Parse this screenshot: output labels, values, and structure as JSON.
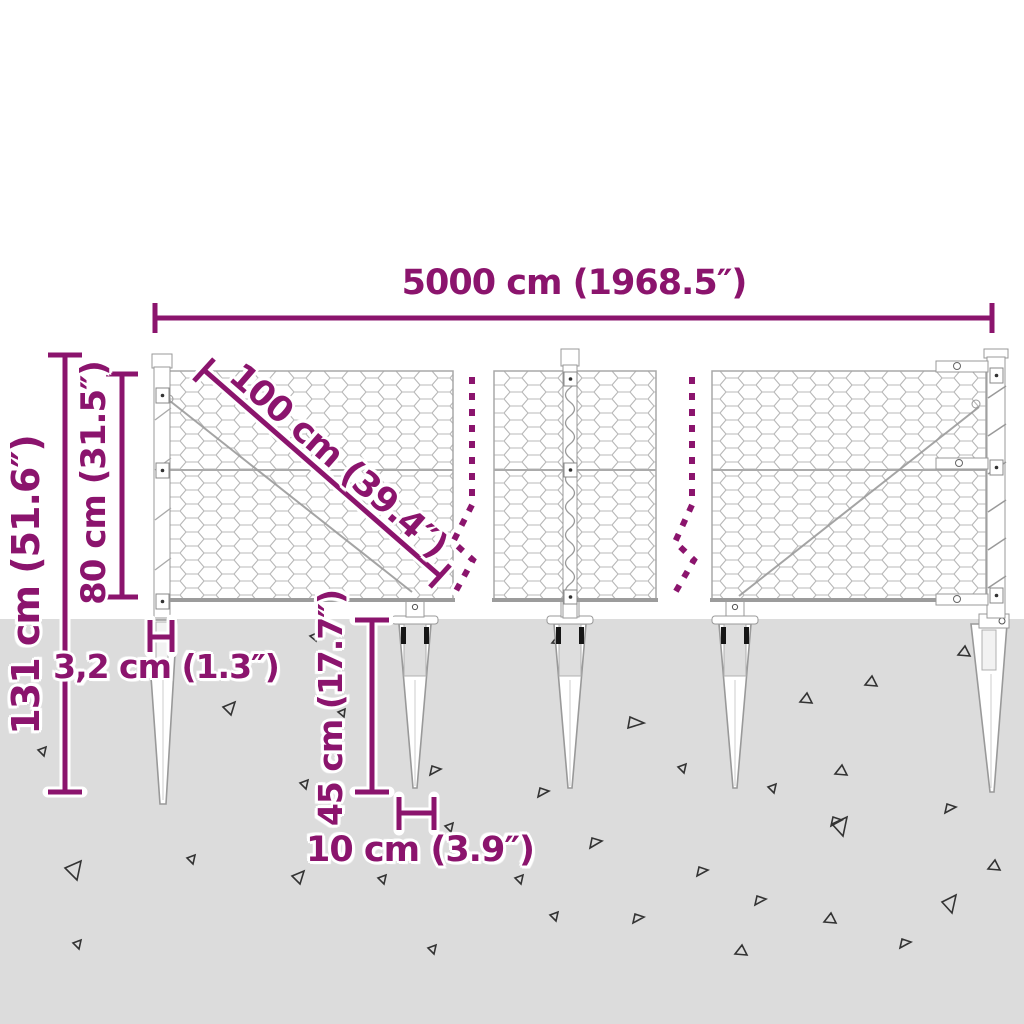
{
  "diagram": {
    "labels": {
      "total_width": "5000 cm (1968.5″)",
      "overall_height": "131 cm (51.6″)",
      "mesh_height": "80 cm (31.5″)",
      "mesh_diagonal": "100 cm (39.4″)",
      "post_width": "3,2 cm (1.3″)",
      "anchor_depth": "45 cm (17.7″)",
      "anchor_width": "10 cm (3.9″)"
    },
    "colors": {
      "dimension_accent": "#8B146D",
      "ground": "#DCDCDC",
      "mesh_wire": "#B8B8B8",
      "structure_outline": "#999999"
    }
  }
}
